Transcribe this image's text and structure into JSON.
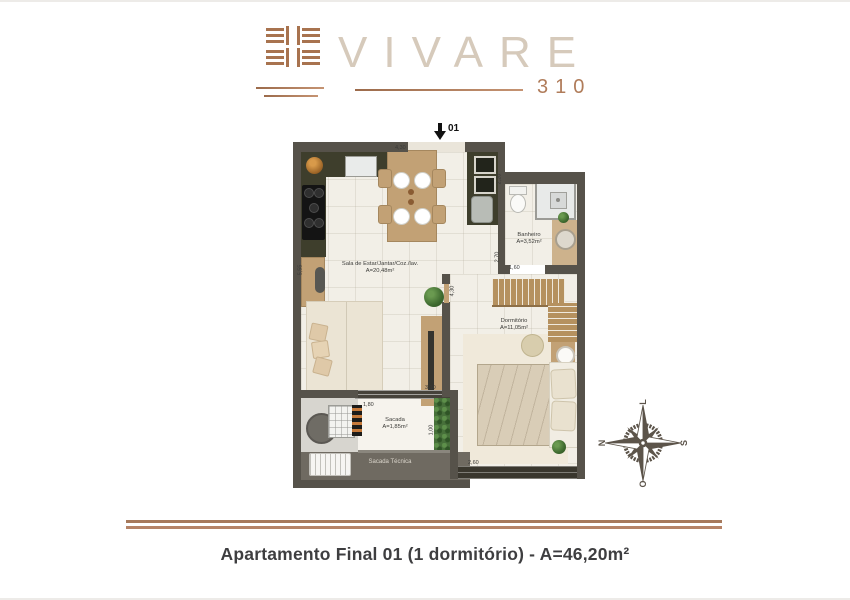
{
  "logo": {
    "brand": "VIVARE",
    "unit": "310"
  },
  "plan": {
    "entrance": "01",
    "rooms": {
      "living": {
        "name": "Sala de Estar/Jantar/Coz./lav.",
        "area": "A=20,48m²"
      },
      "bathroom": {
        "name": "Banheiro",
        "area": "A=3,52m²"
      },
      "bedroom": {
        "name": "Dormitório",
        "area": "A=11,05m²"
      },
      "balcony": {
        "name": "Sacada",
        "area": "A=1,85m²"
      },
      "tech_balcony": {
        "name": "Sacada Técnica"
      }
    },
    "dimensions": [
      "4,30",
      "2,20",
      "2,70",
      "1,60",
      "4,30",
      "5,55",
      "3,10",
      "1,80",
      "1,00",
      "2,60"
    ]
  },
  "compass": {
    "north": "N",
    "east": "L",
    "south": "S",
    "west": "O"
  },
  "caption": "Apartamento Final 01 (1 dormitório) - A=46,20m²",
  "colors": {
    "copper": "#ad7a58",
    "wall": "#56524a",
    "counter": "#3e3e2c",
    "wood": "#c2a175",
    "logo_text": "#d6cabb"
  }
}
